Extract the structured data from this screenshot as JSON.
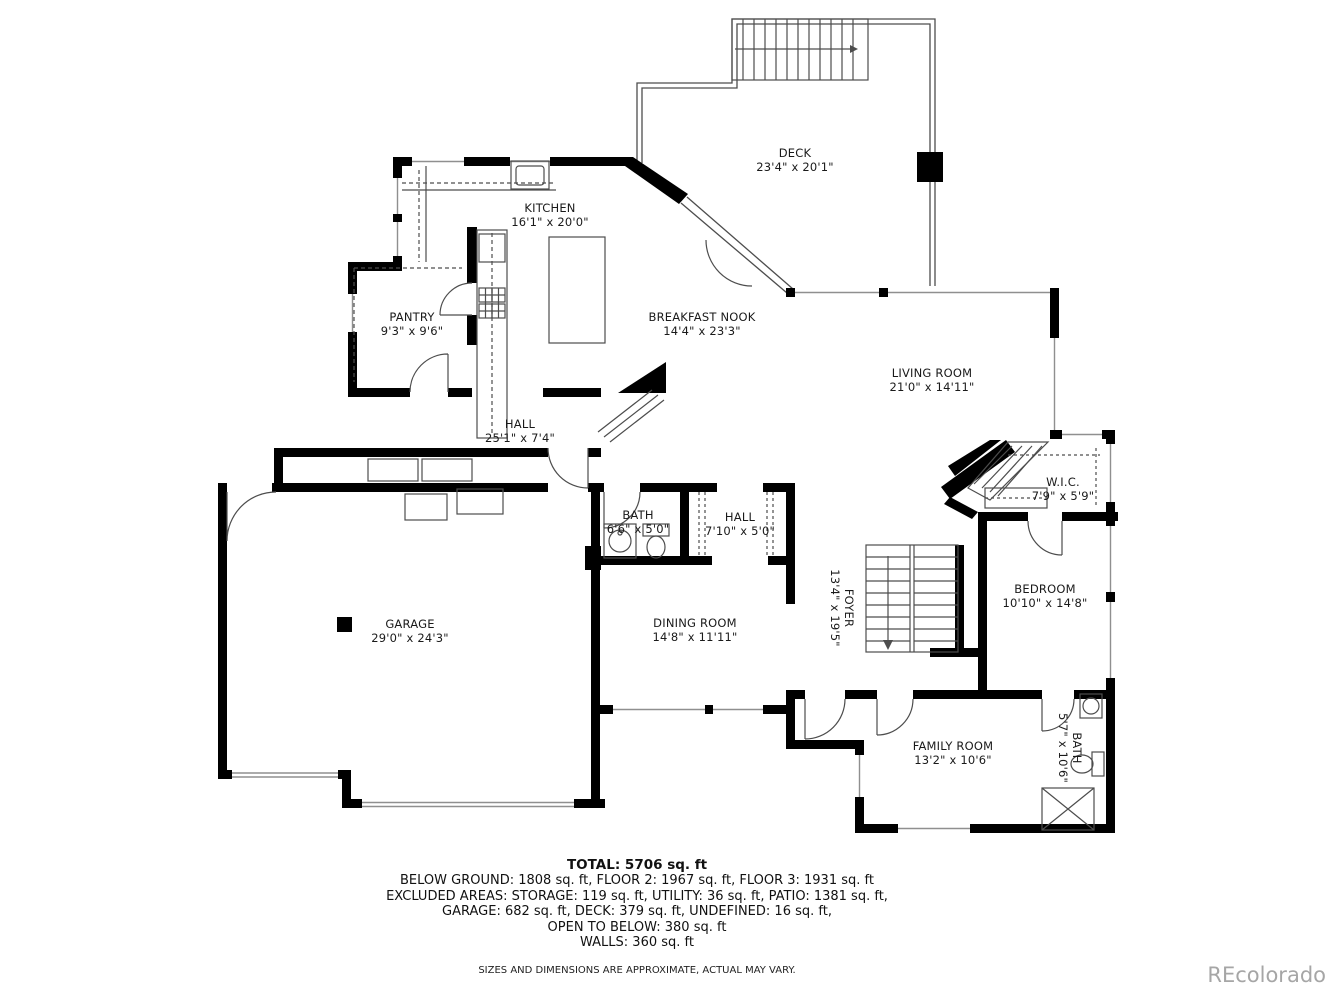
{
  "plan": {
    "rooms": [
      {
        "name": "DECK",
        "dims": "23'4\" x 20'1\""
      },
      {
        "name": "KITCHEN",
        "dims": "16'1\" x 20'0\""
      },
      {
        "name": "PANTRY",
        "dims": "9'3\" x 9'6\""
      },
      {
        "name": "BREAKFAST NOOK",
        "dims": "14'4\" x 23'3\""
      },
      {
        "name": "LIVING ROOM",
        "dims": "21'0\" x 14'11\""
      },
      {
        "name": "HALL",
        "dims": "25'1\" x 7'4\""
      },
      {
        "name": "W.I.C.",
        "dims": "7'9\" x 5'9\""
      },
      {
        "name": "BATH",
        "dims": "6'6\" x 5'0\""
      },
      {
        "name": "HALL",
        "dims": "7'10\" x 5'0\""
      },
      {
        "name": "GARAGE",
        "dims": "29'0\" x 24'3\""
      },
      {
        "name": "DINING ROOM",
        "dims": "14'8\" x 11'11\""
      },
      {
        "name": "FOYER",
        "dims": "13'4\" x 19'5\""
      },
      {
        "name": "BEDROOM",
        "dims": "10'10\" x 14'8\""
      },
      {
        "name": "FAMILY ROOM",
        "dims": "13'2\" x 10'6\""
      },
      {
        "name": "BATH",
        "dims": "5'7\" x 10'6\""
      }
    ],
    "colors": {
      "wall": "#000000",
      "thin_line": "#4d4d4d",
      "window_line": "#8f8f8f",
      "label_text": "#1a1a1a",
      "watermark": "#a6a6a6"
    }
  },
  "footer": {
    "total": "TOTAL: 5706 sq. ft",
    "lines": [
      "BELOW GROUND: 1808 sq. ft, FLOOR 2: 1967 sq. ft, FLOOR 3: 1931 sq. ft",
      "EXCLUDED AREAS: STORAGE: 119 sq. ft, UTILITY: 36 sq. ft, PATIO: 1381 sq. ft,",
      "GARAGE: 682 sq. ft, DECK: 379 sq. ft, UNDEFINED: 16 sq. ft,",
      "OPEN TO BELOW: 380 sq. ft",
      "WALLS: 360 sq. ft"
    ],
    "disclaimer": "SIZES AND DIMENSIONS ARE APPROXIMATE, ACTUAL MAY VARY."
  },
  "watermark": "REcolorado"
}
